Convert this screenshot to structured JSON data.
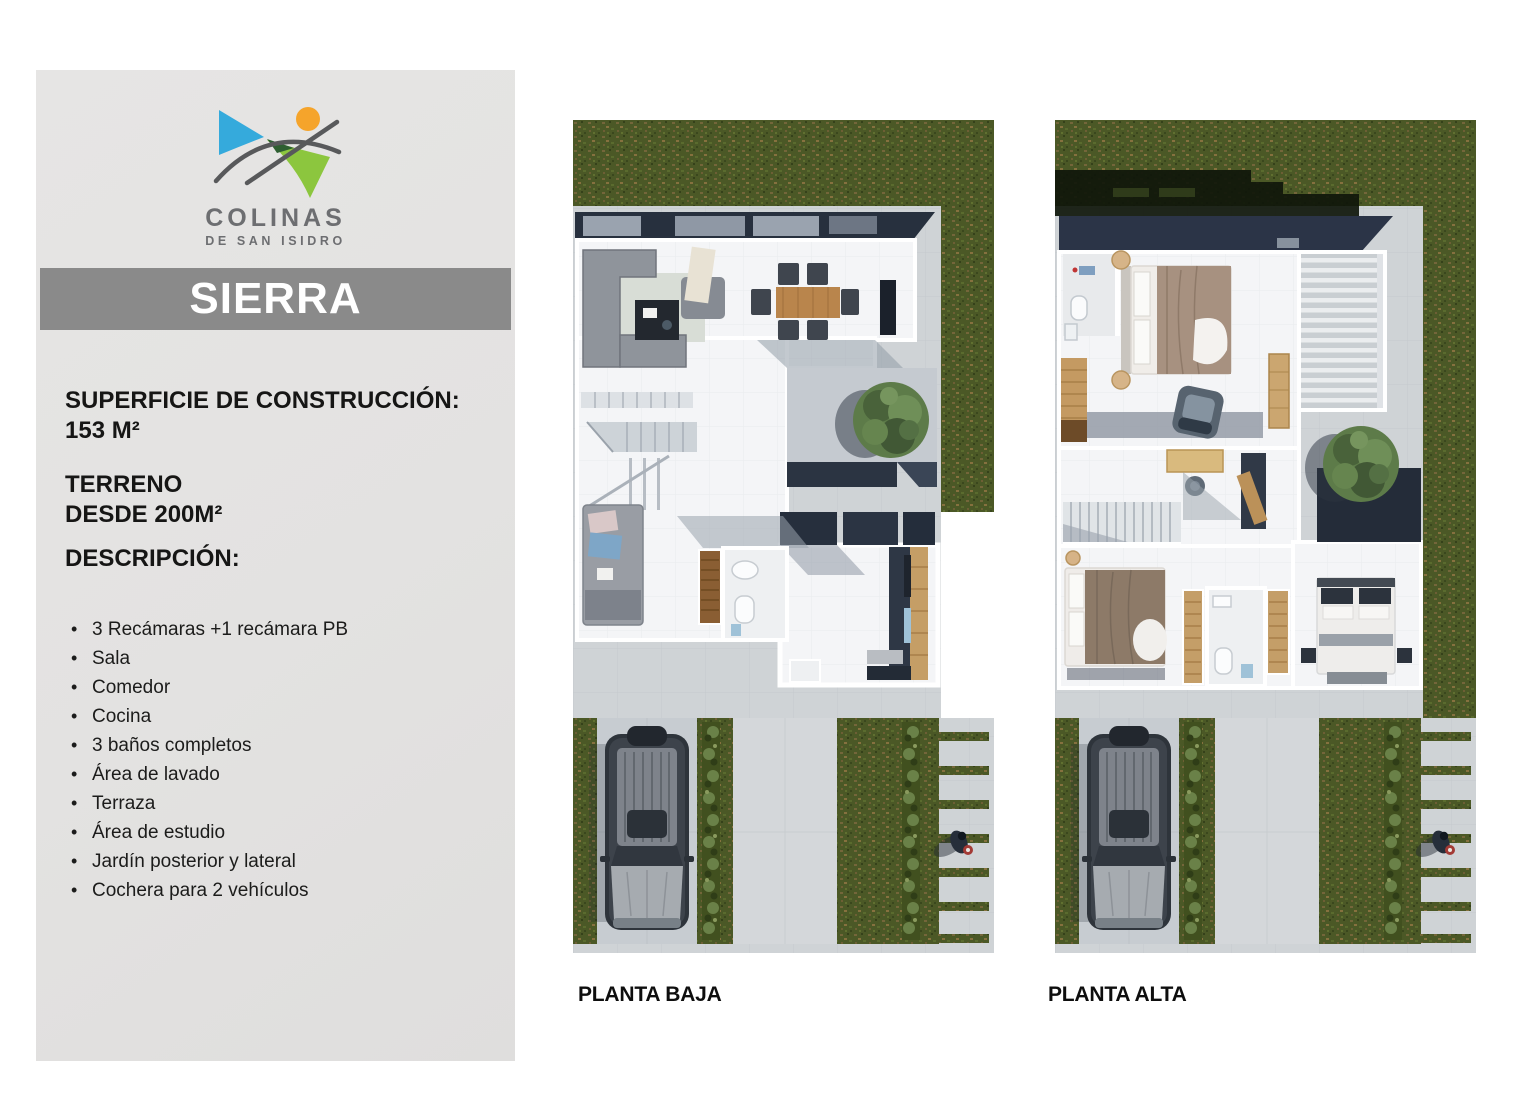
{
  "brand": {
    "name": "COLINAS",
    "tagline": "DE SAN ISIDRO"
  },
  "model": {
    "name": "SIERRA"
  },
  "specs": {
    "construction_label": "SUPERFICIE DE CONSTRUCCIÓN:",
    "construction_value": "153 M²",
    "land_label": "TERRENO",
    "land_value": "DESDE 200M²",
    "description_label": "DESCRIPCIÓN:"
  },
  "features": {
    "items": [
      "3 Recámaras +1 recámara PB",
      "Sala",
      "Comedor",
      "Cocina",
      "3 baños completos",
      "Área de lavado",
      "Terraza",
      "Área de estudio",
      "Jardín posterior y lateral",
      "Cochera para 2 vehículos"
    ]
  },
  "plans": {
    "ground_label": "PLANTA BAJA",
    "upper_label": "PLANTA ALTA"
  },
  "colors": {
    "panel_bg": "#e3e2e1",
    "title_bar_bg": "#8a8a8a",
    "logo_blue": "#35aadc",
    "logo_green": "#8cc63e",
    "logo_dark_green": "#2e5f31",
    "logo_orange": "#f5a42b",
    "logo_gray": "#6d6e71",
    "grass": "#4b5826",
    "roof": "#27303e",
    "pavement": "#cfd3d6",
    "wood": "#c49e66"
  }
}
